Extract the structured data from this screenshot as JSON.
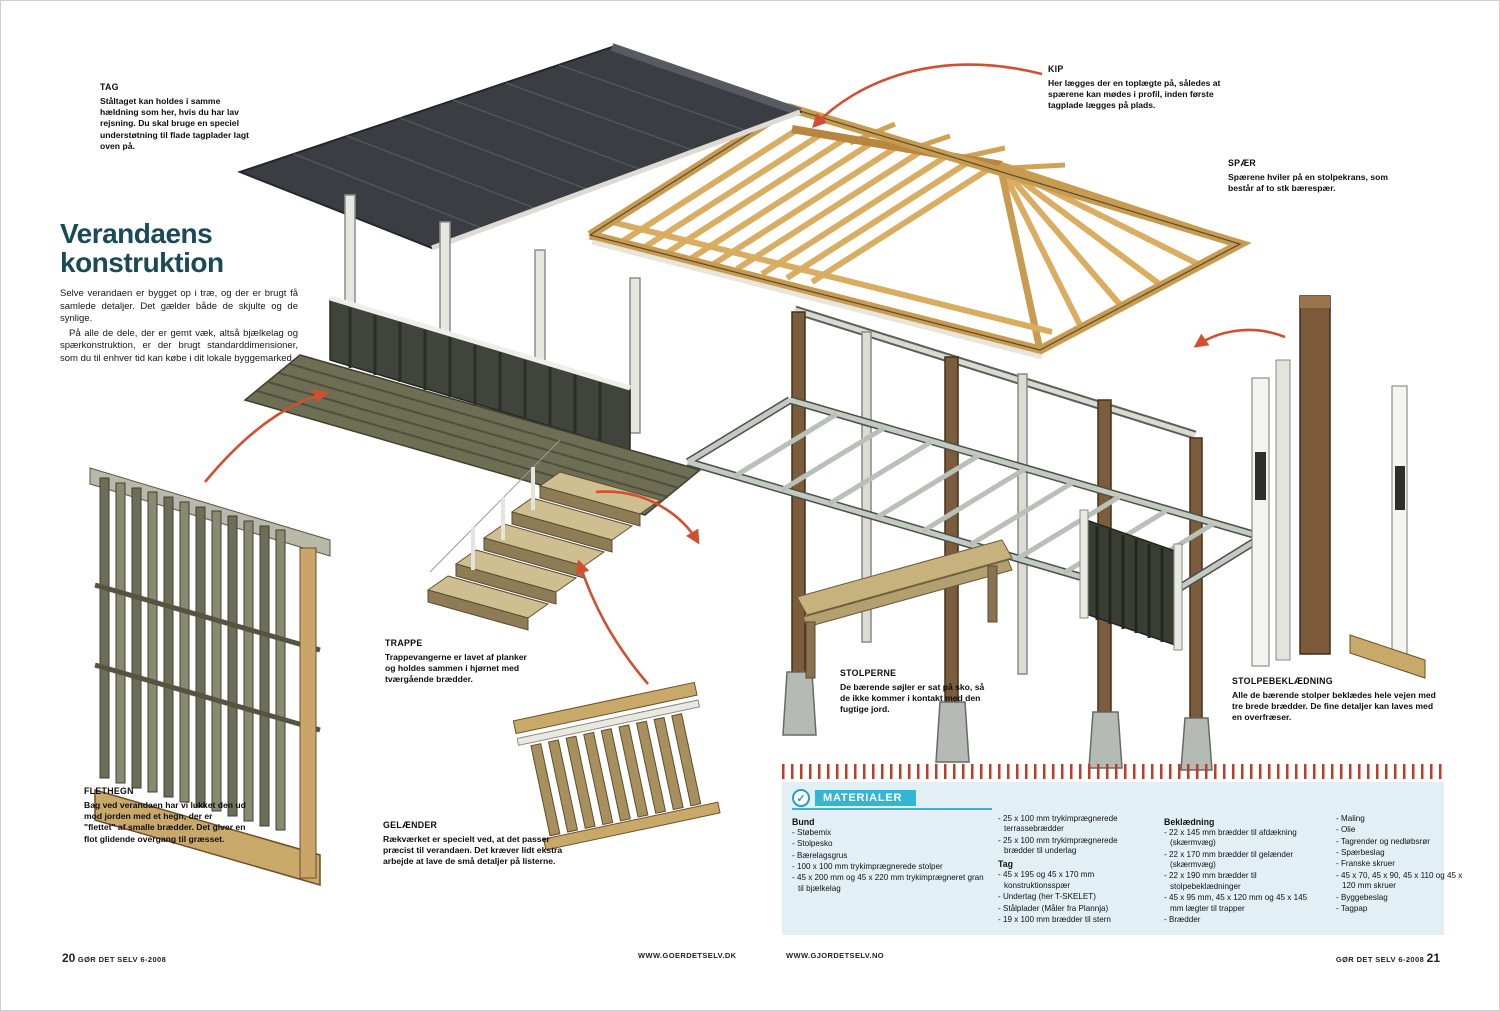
{
  "article": {
    "title_line1": "Verandaens",
    "title_line2": "konstruktion",
    "intro_p1": "Selve verandaen er bygget op i træ, og der er brugt få samlede detaljer. Det gælder både de skjulte og de synlige.",
    "intro_p2": "På alle de dele, der er gemt væk, altså bjælkelag og spærkonstruktion, er der brugt standarddimensioner, som du til enhver tid kan købe i dit lokale byggemarked."
  },
  "callouts": {
    "tag": {
      "heading": "TAG",
      "body": "Ståltaget kan holdes i samme hældning som her, hvis du har lav rejsning. Du skal bruge en speciel understøtning til flade tagplader lagt oven på."
    },
    "kip": {
      "heading": "KIP",
      "body": "Her lægges der en toplægte på, således at spærene kan mødes i profil, inden første tagplade lægges på plads."
    },
    "spaer": {
      "heading": "SPÆR",
      "body": "Spærene hviler på en stolpekrans, som består af to stk bærespær."
    },
    "trappe": {
      "heading": "TRAPPE",
      "body": "Trappevangerne er lavet af planker og holdes sammen i hjørnet med tværgående brædder."
    },
    "stolperne": {
      "heading": "STOLPERNE",
      "body": "De bærende søjler er sat på sko, så de ikke kommer i kontakt med den fugtige jord."
    },
    "stolpebeklaedning": {
      "heading": "STOLPEBEKLÆDNING",
      "body": "Alle de bærende stolper beklædes hele vejen med tre brede brædder. De fine detaljer kan laves med en overfræser."
    },
    "gelaender": {
      "heading": "GELÆNDER",
      "body": "Rækværket er specielt ved, at det passer præcist til verandaen. Det kræver lidt ekstra arbejde at lave de små detaljer på listerne."
    },
    "flethegn": {
      "heading": "FLETHEGN",
      "body": "Bag ved verandaen har vi lukket den ud mod jorden med et hegn, der er \"flettet\" af smalle brædder. Det giver en flot glidende overgang til græsset."
    }
  },
  "materials": {
    "header": "MATERIALER",
    "icon": "materials-badge-icon",
    "columns": [
      {
        "sections": [
          {
            "heading": "Bund",
            "items": [
              "Støbemix",
              "Stolpesko",
              "Bærelagsgrus",
              "100 x 100 mm trykimprægnerede stolper",
              "45 x 200 mm og 45 x 220 mm trykimprægneret gran til bjælkelag"
            ]
          }
        ]
      },
      {
        "sections": [
          {
            "heading": "",
            "items": [
              "25 x 100 mm trykimprægnerede terrassebrædder",
              "25 x 100 mm trykimprægnerede brædder til underlag"
            ]
          },
          {
            "heading": "Tag",
            "items": [
              "45 x 195 og 45 x 170 mm konstruktionsspær",
              "Undertag (her T-SKELET)",
              "Stålplader (Måler fra Plannja)",
              "19 x 100 mm brædder til stern"
            ]
          }
        ]
      },
      {
        "sections": [
          {
            "heading": "Beklædning",
            "items": [
              "22 x 145 mm brædder til afdækning (skærmvæg)",
              "22 x 170 mm brædder til gelænder (skærmvæg)",
              "22 x 190 mm brædder til stolpebeklædninger",
              "45 x 95 mm, 45 x 120 mm og 45 x 145 mm lægter til trapper",
              "Brædder"
            ]
          }
        ]
      },
      {
        "sections": [
          {
            "heading": "",
            "items": [
              "Maling",
              "Olie",
              "Tagrender og nedløbsrør",
              "Spærbeslag",
              "Franske skruer",
              "45 x 70, 45 x 90, 45 x 110 og 45 x 120 mm skruer",
              "Byggebeslag",
              "Tagpap"
            ]
          }
        ]
      }
    ]
  },
  "footer": {
    "left_page": "20",
    "left_text": "GØR DET SELV 6-2008",
    "url_left": "WWW.GOERDETSELV.DK",
    "url_right": "WWW.GJORDETSELV.NO",
    "right_text": "GØR DET SELV 6-2008",
    "right_page": "21"
  },
  "colors": {
    "accent_red": "#d14f2e",
    "title_teal": "#1a4a57",
    "materials_cyan": "#35b5d6",
    "materials_bg": "#e2f0f6",
    "wood_light": "#d9ad62",
    "wood_brown": "#7b5c3d",
    "roof_dark": "#3a3d41"
  }
}
